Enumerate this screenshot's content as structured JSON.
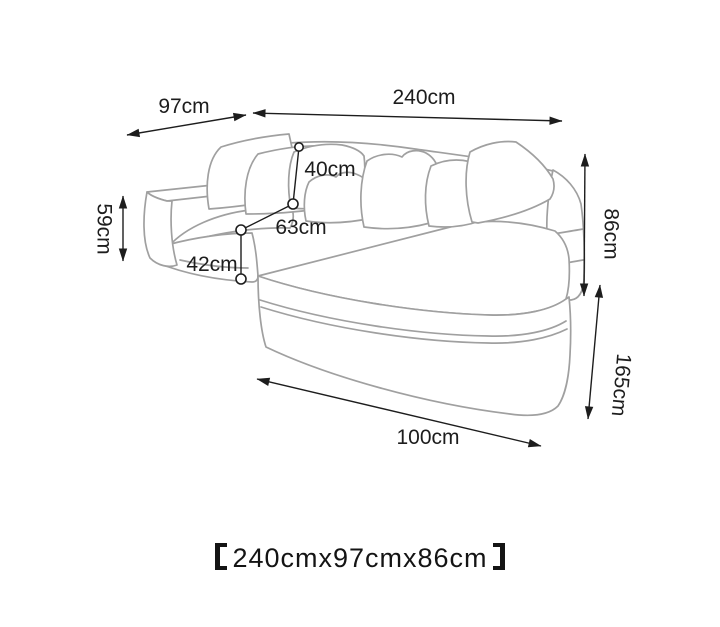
{
  "page": {
    "background": "#ffffff"
  },
  "diagram": {
    "subject": "l-shaped-chaise-sofa-dimension-line-drawing",
    "colors": {
      "sofa_outline": "#a0a0a0",
      "dimension_lines": "#1d1d1d",
      "label_text": "#1d1d1d",
      "background": "#ffffff"
    },
    "labels": {
      "overall_width": "240cm",
      "overall_depth": "97cm",
      "back_cushion_height": "40cm",
      "seat_depth": "63cm",
      "seat_height": "42cm",
      "arm_height": "59cm",
      "overall_height": "86cm",
      "chaise_length": "165cm",
      "chaise_width": "100cm"
    },
    "caption": {
      "full": "【240cmx97cmx86cm】",
      "left_bracket": "【",
      "text": "240cmx97cmx86cm",
      "right_bracket": "】"
    }
  }
}
